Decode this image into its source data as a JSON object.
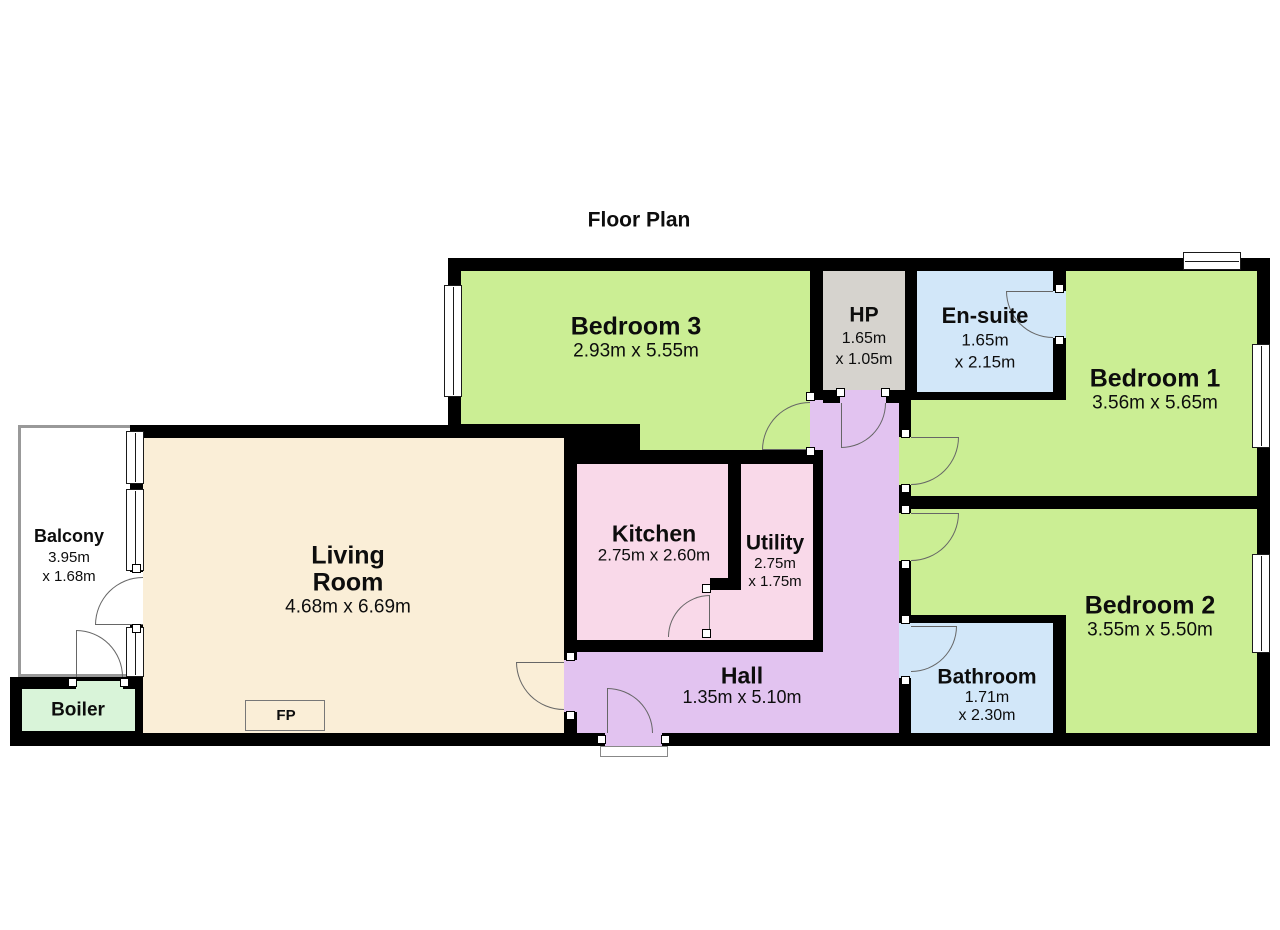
{
  "title": "Floor Plan",
  "palette": {
    "wall": "#000000",
    "bedroom_green": "#cbee94",
    "hp_gray": "#d6d3ce",
    "wet_room_blue": "#d2e7f9",
    "living_beige": "#faeed7",
    "kitchen_pink": "#f9d9e9",
    "hall_purple": "#e2c3f0",
    "boiler_green": "#d9f4d9"
  },
  "rooms": {
    "bedroom3": {
      "name": "Bedroom 3",
      "dims": "2.93m x 5.55m"
    },
    "hp": {
      "name": "HP",
      "dim1": "1.65m",
      "dim2": "x 1.05m"
    },
    "ensuite": {
      "name": "En-suite",
      "dim1": "1.65m",
      "dim2": "x 2.15m"
    },
    "bedroom1": {
      "name": "Bedroom 1",
      "dims": "3.56m x 5.65m"
    },
    "bedroom2": {
      "name": "Bedroom 2",
      "dims": "3.55m x 5.50m"
    },
    "bathroom": {
      "name": "Bathroom",
      "dim1": "1.71m",
      "dim2": "x 2.30m"
    },
    "balcony": {
      "name": "Balcony",
      "dim1": "3.95m",
      "dim2": "x 1.68m"
    },
    "living": {
      "name1": "Living",
      "name2": "Room",
      "dims": "4.68m x 6.69m"
    },
    "kitchen": {
      "name": "Kitchen",
      "dims": "2.75m x 2.60m"
    },
    "utility": {
      "name": "Utility",
      "dim1": "2.75m",
      "dim2": "x 1.75m"
    },
    "hall": {
      "name": "Hall",
      "dims": "1.35m x 5.10m"
    },
    "boiler": {
      "name": "Boiler"
    },
    "fireplace": {
      "label": "FP"
    }
  }
}
